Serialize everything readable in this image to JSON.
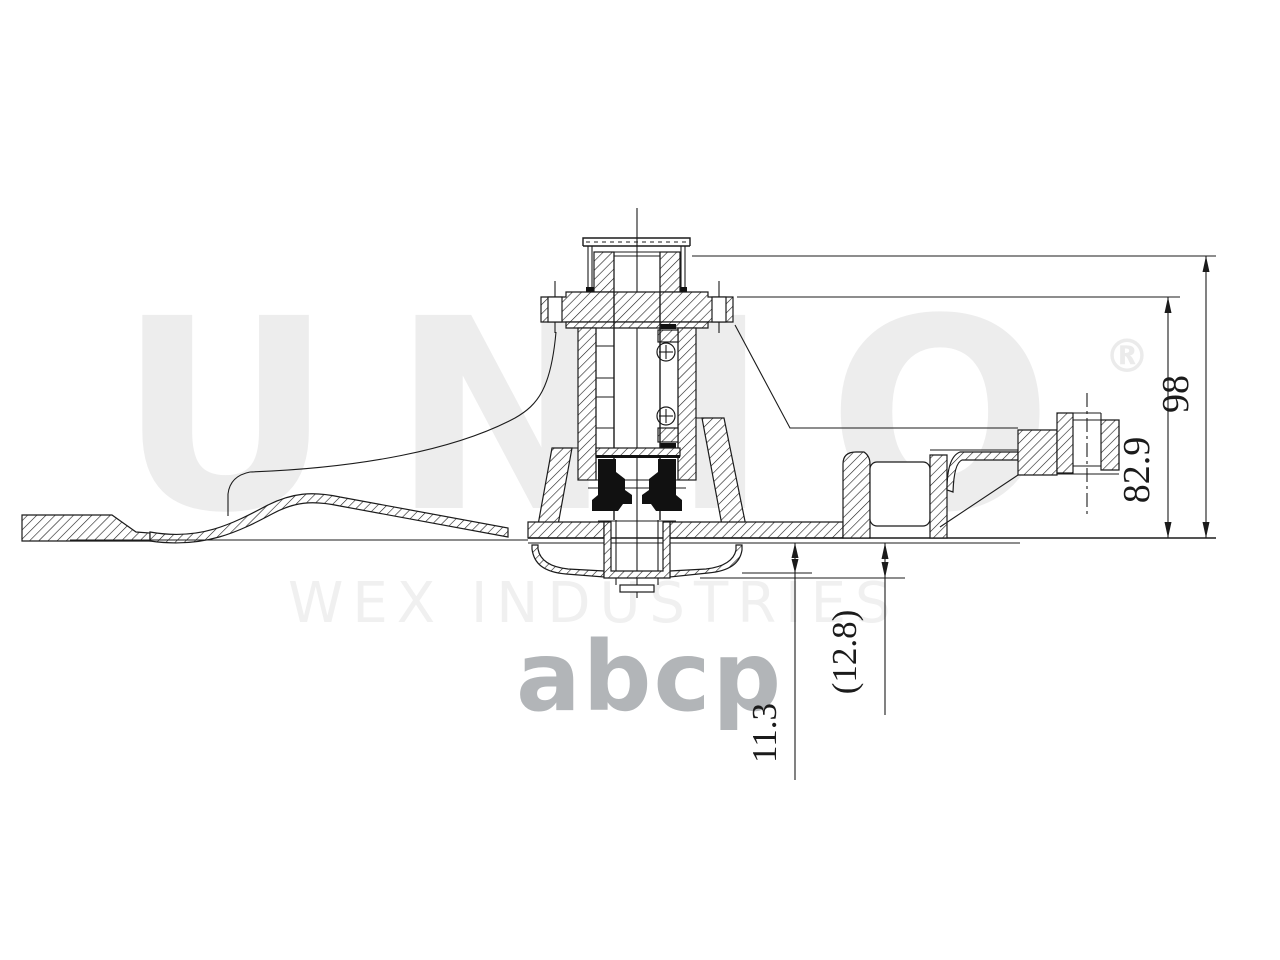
{
  "drawing": {
    "type": "water-pump-cross-section",
    "dimensions": {
      "overall_height": "98",
      "flange_to_base_height": "82.9",
      "base_to_impeller_depth": "11.3",
      "base_to_impeller_ref_depth": "(12.8)"
    }
  },
  "watermarks": {
    "brand": "UNIO",
    "registered_mark": "®",
    "subtitle": "WEX INDUSTRIES",
    "store": "abcp"
  },
  "colors": {
    "line": "#1b1b1b",
    "background": "#ffffff",
    "watermark_light": "#ededed",
    "watermark_medium": "#b2b5b8",
    "seal_fill": "#111111"
  }
}
